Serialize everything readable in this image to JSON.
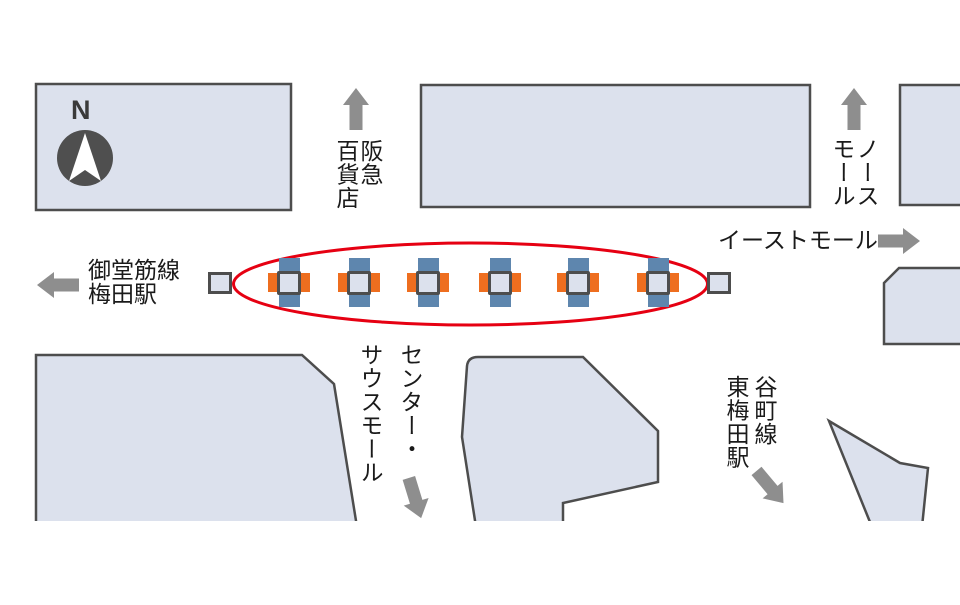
{
  "map_title": "梅田駅周辺案内図",
  "compass": {
    "north_label": "N"
  },
  "labels": {
    "hankyu": {
      "lines": [
        "阪急",
        "百貨店"
      ],
      "direction": "up"
    },
    "north_mall": {
      "lines": [
        "ノース",
        "モール"
      ],
      "direction": "up"
    },
    "east_mall": {
      "text": "イーストモール",
      "direction": "right"
    },
    "midosuji": {
      "lines": [
        "御堂筋線",
        "梅田駅"
      ],
      "direction": "left"
    },
    "center_south_mall": {
      "lines": [
        "センター・",
        "サウスモール"
      ],
      "direction": "down"
    },
    "tanimachi": {
      "lines": [
        "谷町線",
        "東梅田駅"
      ],
      "direction": "down-right"
    }
  },
  "highlight": {
    "shape": "ellipse",
    "pillar_count": 6,
    "end_square_count": 2
  },
  "colors": {
    "building_fill": "#dce1ed",
    "building_border": "#4d4d4d",
    "arrow_gray": "#8e8e8e",
    "text": "#1a1a1a",
    "highlight_red": "#e60012",
    "pillar_blue": "#5e86ae",
    "pillar_orange": "#ee6e1f",
    "compass_dark": "#4f4f4f"
  }
}
